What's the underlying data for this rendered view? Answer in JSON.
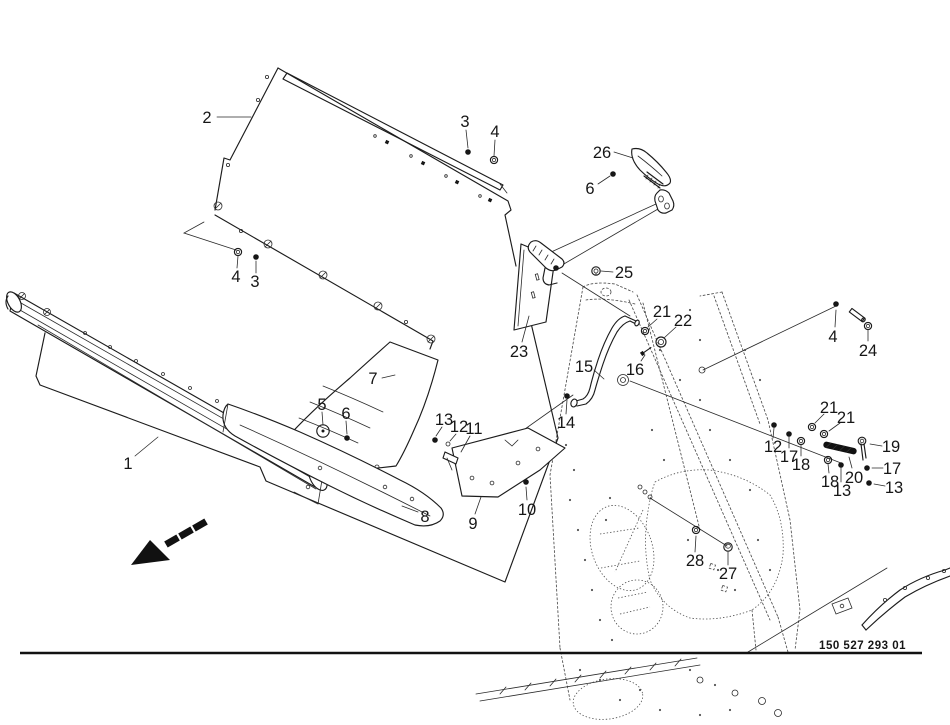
{
  "figure": {
    "title": "exploded-parts-diagram",
    "drawing_number": "150 527 293 01",
    "background": "#ffffff",
    "line_color": "#1c1c1c",
    "phantom_color": "#4d4d4d"
  },
  "callouts": [
    {
      "label": "1",
      "x": 128,
      "y": 463,
      "leader": [
        [
          135,
          456
        ],
        [
          158,
          437
        ]
      ]
    },
    {
      "label": "2",
      "x": 207,
      "y": 117,
      "leader": [
        [
          217,
          117
        ],
        [
          251,
          117
        ]
      ]
    },
    {
      "label": "3",
      "x": 465,
      "y": 121,
      "leader": [
        [
          466,
          130
        ],
        [
          468,
          148
        ]
      ]
    },
    {
      "label": "4",
      "x": 495,
      "y": 131,
      "leader": [
        [
          495,
          140
        ],
        [
          494,
          156
        ]
      ]
    },
    {
      "label": "4",
      "x": 236,
      "y": 276,
      "leader": [
        [
          237,
          268
        ],
        [
          238,
          256
        ]
      ]
    },
    {
      "label": "3",
      "x": 255,
      "y": 281,
      "leader": [
        [
          256,
          273
        ],
        [
          256,
          261
        ]
      ]
    },
    {
      "label": "5",
      "x": 322,
      "y": 404,
      "leader": [
        [
          322,
          412
        ],
        [
          323,
          425
        ]
      ]
    },
    {
      "label": "6",
      "x": 346,
      "y": 413,
      "leader": [
        [
          346,
          421
        ],
        [
          347,
          434
        ]
      ]
    },
    {
      "label": "7",
      "x": 373,
      "y": 378,
      "leader": [
        [
          382,
          378
        ],
        [
          395,
          375
        ]
      ]
    },
    {
      "label": "8",
      "x": 425,
      "y": 516,
      "leader": [
        [
          418,
          512
        ],
        [
          402,
          506
        ]
      ]
    },
    {
      "label": "9",
      "x": 473,
      "y": 523,
      "leader": [
        [
          475,
          514
        ],
        [
          481,
          497
        ]
      ]
    },
    {
      "label": "10",
      "x": 527,
      "y": 509,
      "leader": [
        [
          527,
          500
        ],
        [
          526,
          487
        ]
      ]
    },
    {
      "label": "11",
      "x": 474,
      "y": 428,
      "leader": [
        [
          470,
          436
        ],
        [
          461,
          452
        ]
      ]
    },
    {
      "label": "12",
      "x": 459,
      "y": 426,
      "leader": [
        [
          456,
          434
        ],
        [
          450,
          441
        ]
      ]
    },
    {
      "label": "13",
      "x": 444,
      "y": 419,
      "leader": [
        [
          442,
          427
        ],
        [
          436,
          436
        ]
      ]
    },
    {
      "label": "14",
      "x": 566,
      "y": 422,
      "leader": [
        [
          566,
          414
        ],
        [
          567,
          400
        ]
      ]
    },
    {
      "label": "15",
      "x": 584,
      "y": 366,
      "leader": [
        [
          594,
          370
        ],
        [
          604,
          379
        ]
      ]
    },
    {
      "label": "16",
      "x": 635,
      "y": 369,
      "leader": [
        [
          641,
          361
        ],
        [
          645,
          355
        ]
      ]
    },
    {
      "label": "21",
      "x": 662,
      "y": 311,
      "leader": [
        [
          657,
          319
        ],
        [
          648,
          327
        ]
      ]
    },
    {
      "label": "22",
      "x": 683,
      "y": 320,
      "leader": [
        [
          676,
          327
        ],
        [
          664,
          338
        ]
      ]
    },
    {
      "label": "23",
      "x": 519,
      "y": 351,
      "leader": [
        [
          522,
          342
        ],
        [
          529,
          316
        ]
      ]
    },
    {
      "label": "25",
      "x": 624,
      "y": 272,
      "leader": [
        [
          613,
          272
        ],
        [
          601,
          271
        ]
      ]
    },
    {
      "label": "26",
      "x": 602,
      "y": 152,
      "leader": [
        [
          614,
          152
        ],
        [
          633,
          158
        ]
      ]
    },
    {
      "label": "6",
      "x": 590,
      "y": 188,
      "leader": [
        [
          598,
          184
        ],
        [
          610,
          176
        ]
      ]
    },
    {
      "label": "4",
      "x": 833,
      "y": 336,
      "leader": [
        [
          835,
          327
        ],
        [
          836,
          310
        ]
      ]
    },
    {
      "label": "24",
      "x": 868,
      "y": 350,
      "leader": [
        [
          868,
          341
        ],
        [
          868,
          330
        ]
      ]
    },
    {
      "label": "21",
      "x": 829,
      "y": 407,
      "leader": [
        [
          824,
          414
        ],
        [
          815,
          423
        ]
      ]
    },
    {
      "label": "21",
      "x": 846,
      "y": 417,
      "leader": [
        [
          840,
          423
        ],
        [
          829,
          431
        ]
      ]
    },
    {
      "label": "12",
      "x": 773,
      "y": 446,
      "leader": [
        [
          773,
          438
        ],
        [
          774,
          428
        ]
      ]
    },
    {
      "label": "17",
      "x": 789,
      "y": 456,
      "leader": [
        [
          789,
          448
        ],
        [
          789,
          437
        ]
      ]
    },
    {
      "label": "18",
      "x": 801,
      "y": 464,
      "leader": [
        [
          801,
          456
        ],
        [
          801,
          445
        ]
      ]
    },
    {
      "label": "18",
      "x": 830,
      "y": 481,
      "leader": [
        [
          829,
          473
        ],
        [
          828,
          464
        ]
      ]
    },
    {
      "label": "13",
      "x": 842,
      "y": 490,
      "leader": [
        [
          841,
          482
        ],
        [
          841,
          468
        ]
      ]
    },
    {
      "label": "19",
      "x": 891,
      "y": 446,
      "leader": [
        [
          882,
          446
        ],
        [
          870,
          444
        ]
      ]
    },
    {
      "label": "20",
      "x": 854,
      "y": 477,
      "leader": [
        [
          852,
          468
        ],
        [
          849,
          457
        ]
      ]
    },
    {
      "label": "17",
      "x": 892,
      "y": 468,
      "leader": [
        [
          883,
          468
        ],
        [
          872,
          468
        ]
      ]
    },
    {
      "label": "13",
      "x": 894,
      "y": 487,
      "leader": [
        [
          885,
          486
        ],
        [
          874,
          484
        ]
      ]
    },
    {
      "label": "27",
      "x": 728,
      "y": 573,
      "leader": [
        [
          728,
          565
        ],
        [
          728,
          552
        ]
      ]
    },
    {
      "label": "28",
      "x": 695,
      "y": 560,
      "leader": [
        [
          695,
          552
        ],
        [
          696,
          536
        ]
      ]
    }
  ],
  "fasteners": [
    {
      "type": "bolt",
      "name": "hex-bolt",
      "x": 468,
      "y": 152
    },
    {
      "type": "washer",
      "name": "washer",
      "x": 494,
      "y": 160
    },
    {
      "type": "washer",
      "name": "washer",
      "x": 238,
      "y": 252
    },
    {
      "type": "bolt",
      "name": "hex-bolt",
      "x": 256,
      "y": 257
    },
    {
      "type": "bolt",
      "name": "hex-bolt",
      "x": 613,
      "y": 174
    },
    {
      "type": "nut",
      "name": "lock-nut",
      "x": 596,
      "y": 271
    },
    {
      "type": "circledot",
      "name": "cap-washer",
      "x": 323,
      "y": 431
    },
    {
      "type": "bolt",
      "name": "hex-bolt",
      "x": 347,
      "y": 438
    },
    {
      "type": "bolt",
      "name": "hex-bolt",
      "x": 435,
      "y": 440
    },
    {
      "type": "smallring",
      "name": "washer",
      "x": 448,
      "y": 444
    },
    {
      "type": "bolt",
      "name": "hex-bolt",
      "x": 526,
      "y": 482
    },
    {
      "type": "bolt",
      "name": "pivot-bolt",
      "x": 567,
      "y": 396
    },
    {
      "type": "screw",
      "name": "set-screw",
      "x": 646,
      "y": 351,
      "rot": -35
    },
    {
      "type": "washer",
      "name": "washer",
      "x": 645,
      "y": 331
    },
    {
      "type": "bigring",
      "name": "bushing",
      "x": 661,
      "y": 342
    },
    {
      "type": "bolt",
      "name": "hex-bolt",
      "x": 836,
      "y": 304
    },
    {
      "type": "pin",
      "name": "clevis-pin",
      "x": 857,
      "y": 315,
      "rot": 37
    },
    {
      "type": "washer",
      "name": "washer",
      "x": 868,
      "y": 326
    },
    {
      "type": "washer",
      "name": "washer",
      "x": 812,
      "y": 427
    },
    {
      "type": "washer",
      "name": "washer",
      "x": 824,
      "y": 434
    },
    {
      "type": "bolt",
      "name": "hex-bolt",
      "x": 774,
      "y": 425
    },
    {
      "type": "bolt",
      "name": "hex-bolt",
      "x": 789,
      "y": 434
    },
    {
      "type": "washer",
      "name": "washer",
      "x": 801,
      "y": 441
    },
    {
      "type": "washer",
      "name": "washer",
      "x": 828,
      "y": 460
    },
    {
      "type": "bolt",
      "name": "hex-bolt",
      "x": 841,
      "y": 465
    },
    {
      "type": "spring",
      "name": "tension-spring",
      "x": 840,
      "y": 448,
      "rot": 13
    },
    {
      "type": "cotter",
      "name": "linch-pin",
      "x": 862,
      "y": 441
    },
    {
      "type": "bolt",
      "name": "hex-bolt",
      "x": 867,
      "y": 468
    },
    {
      "type": "bolt",
      "name": "hex-bolt",
      "x": 869,
      "y": 483
    },
    {
      "type": "washer",
      "name": "washer",
      "x": 696,
      "y": 530
    },
    {
      "type": "bolthead",
      "name": "carriage-bolt",
      "x": 728,
      "y": 547
    },
    {
      "type": "bolt",
      "name": "clamp-bolt",
      "x": 556,
      "y": 268
    },
    {
      "type": "smallring",
      "name": "screw",
      "x": 640,
      "y": 487
    },
    {
      "type": "smallring",
      "name": "screw",
      "x": 645,
      "y": 492
    },
    {
      "type": "smallring",
      "name": "screw",
      "x": 650,
      "y": 497
    }
  ],
  "direction_arrow": {
    "tip": [
      131,
      565
    ],
    "head": [
      [
        131,
        565
      ],
      [
        150,
        540
      ],
      [
        170,
        560
      ]
    ],
    "dashes": [
      {
        "x": 172,
        "y": 541
      },
      {
        "x": 186,
        "y": 533
      },
      {
        "x": 200,
        "y": 525
      }
    ],
    "rot": -30
  }
}
